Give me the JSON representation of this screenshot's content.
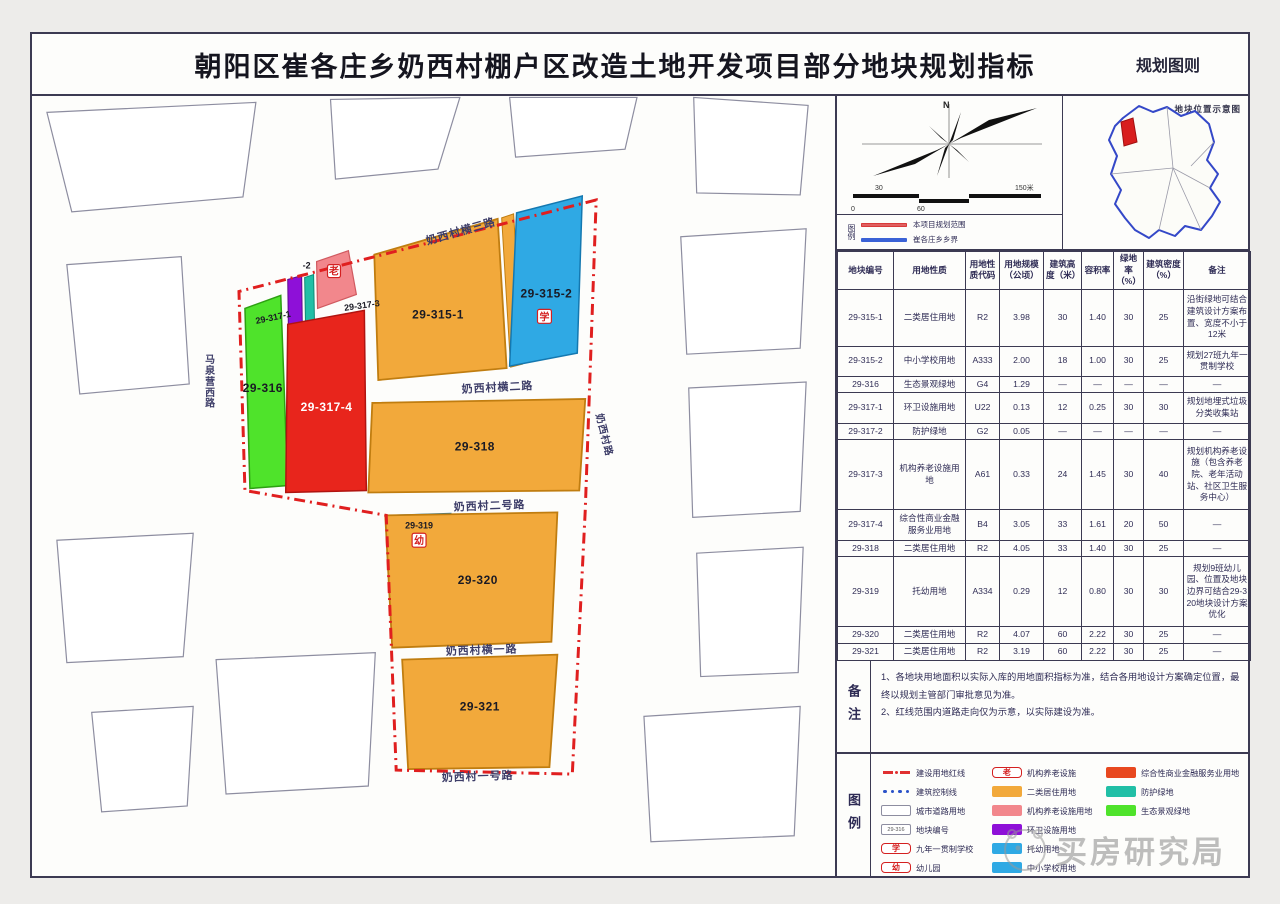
{
  "title": "朝阳区崔各庄乡奶西村棚户区改造土地开发项目部分地块规划指标",
  "subtitle": "规划图则",
  "compass": {
    "north": "N",
    "scale": {
      "above": [
        "30",
        "150米"
      ],
      "below": [
        "0",
        "60"
      ]
    }
  },
  "mini_legend": {
    "label": "图例",
    "items": [
      {
        "label": "本项目规划范围",
        "color": "#e06060"
      },
      {
        "label": "崔各庄乡乡界",
        "color": "#3b62d6"
      }
    ]
  },
  "inset": {
    "title": "地块位置示意图"
  },
  "map": {
    "roads": [
      "奶西村横三路",
      "奶西村横二路",
      "奶西村二号路",
      "奶西村横一路",
      "奶西村一号路",
      "马泉营西路",
      "奶西村路"
    ],
    "plots": [
      {
        "id": "29-315-1",
        "label": "29-315-1"
      },
      {
        "id": "29-315-2",
        "label": "29-315-2",
        "icon": "学"
      },
      {
        "id": "29-316",
        "label": "29-316"
      },
      {
        "id": "29-317-1",
        "label": "29-317-1"
      },
      {
        "id": "29-317-2",
        "label": "-2"
      },
      {
        "id": "29-317-3",
        "label": "29-317-3",
        "icon": "老"
      },
      {
        "id": "29-317-4",
        "label": "29-317-4"
      },
      {
        "id": "29-318",
        "label": "29-318"
      },
      {
        "id": "29-319",
        "label": "29-319",
        "icon": "幼"
      },
      {
        "id": "29-320",
        "label": "29-320"
      },
      {
        "id": "29-321",
        "label": "29-321"
      }
    ],
    "icons": {
      "school": "学",
      "kindergarten": "幼",
      "elderly": "老"
    }
  },
  "table": {
    "headers": [
      "地块编号",
      "用地性质",
      "用地性质代码",
      "用地规模（公顷）",
      "建筑高度（米）",
      "容积率",
      "绿地率（%）",
      "建筑密度（%）",
      "备注"
    ],
    "rows": [
      [
        "29-315-1",
        "二类居住用地",
        "R2",
        "3.98",
        "30",
        "1.40",
        "30",
        "25",
        "沿街绿地可结合建筑设计方案布置、宽度不小于12米"
      ],
      [
        "29-315-2",
        "中小学校用地",
        "A333",
        "2.00",
        "18",
        "1.00",
        "30",
        "25",
        "规划27班九年一贯制学校"
      ],
      [
        "29-316",
        "生态景观绿地",
        "G4",
        "1.29",
        "—",
        "—",
        "—",
        "—",
        "—"
      ],
      [
        "29-317-1",
        "环卫设施用地",
        "U22",
        "0.13",
        "12",
        "0.25",
        "30",
        "30",
        "规划地埋式垃圾分类收集站"
      ],
      [
        "29-317-2",
        "防护绿地",
        "G2",
        "0.05",
        "—",
        "—",
        "—",
        "—",
        "—"
      ],
      [
        "29-317-3",
        "机构养老设施用地",
        "A61",
        "0.33",
        "24",
        "1.45",
        "30",
        "40",
        "规划机构养老设施（包含养老院、老年活动站、社区卫生服务中心）"
      ],
      [
        "29-317-4",
        "综合性商业金融服务业用地",
        "B4",
        "3.05",
        "33",
        "1.61",
        "20",
        "50",
        "—"
      ],
      [
        "29-318",
        "二类居住用地",
        "R2",
        "4.05",
        "33",
        "1.40",
        "30",
        "25",
        "—"
      ],
      [
        "29-319",
        "托幼用地",
        "A334",
        "0.29",
        "12",
        "0.80",
        "30",
        "30",
        "规划9班幼儿园、位置及地块边界可结合29-320地块设计方案优化"
      ],
      [
        "29-320",
        "二类居住用地",
        "R2",
        "4.07",
        "60",
        "2.22",
        "30",
        "25",
        "—"
      ],
      [
        "29-321",
        "二类居住用地",
        "R2",
        "3.19",
        "60",
        "2.22",
        "30",
        "25",
        "—"
      ]
    ]
  },
  "notes": {
    "label": "备注",
    "items": [
      "1、各地块用地面积以实际入库的用地面积指标为准，结合各用地设计方案确定位置，最终以规划主管部门审批意见为准。",
      "2、红线范围内道路走向仅为示意，以实际建设为准。"
    ]
  },
  "legend": {
    "label": "图例",
    "columns": [
      [
        {
          "swatch": "dashdot",
          "label": "建设用地红线"
        },
        {
          "swatch": "dots",
          "label": "建筑控制线"
        },
        {
          "swatch": "rect-outline",
          "label": "城市道路用地"
        },
        {
          "swatch": "rect-code",
          "text": "29-316",
          "label": "地块编号"
        },
        {
          "swatch": "pill",
          "char": "学",
          "label": "九年一贯制学校"
        },
        {
          "swatch": "pill",
          "char": "幼",
          "label": "幼儿园"
        }
      ],
      [
        {
          "swatch": "pill",
          "char": "老",
          "label": "机构养老设施"
        },
        {
          "swatch": "fill",
          "color": "#F2A93B",
          "label": "二类居住用地"
        },
        {
          "swatch": "fill",
          "color": "#F2878C",
          "label": "机构养老设施用地"
        },
        {
          "swatch": "fill",
          "color": "#8E10D8",
          "label": "环卫设施用地"
        },
        {
          "swatch": "fill",
          "color": "#2FA9E4",
          "label": "托幼用地"
        },
        {
          "swatch": "fill",
          "color": "#2FA9E4",
          "label": "中小学校用地"
        }
      ],
      [
        {
          "swatch": "fill",
          "color": "#E8481F",
          "label": "综合性商业金融服务业用地"
        },
        {
          "swatch": "fill",
          "color": "#21BFA6",
          "label": "防护绿地"
        },
        {
          "swatch": "fill",
          "color": "#4FE32B",
          "label": "生态景观绿地"
        }
      ]
    ]
  },
  "watermark": "买房研究局",
  "colors": {
    "residential": "#F2A93B",
    "school": "#2FA9E4",
    "eco_green": "#4FE32B",
    "commercial": "#E8251C",
    "elderly": "#F2878C",
    "sanitation": "#8E10D8",
    "protective": "#21BFA6",
    "boundary": "#E01F1F"
  }
}
